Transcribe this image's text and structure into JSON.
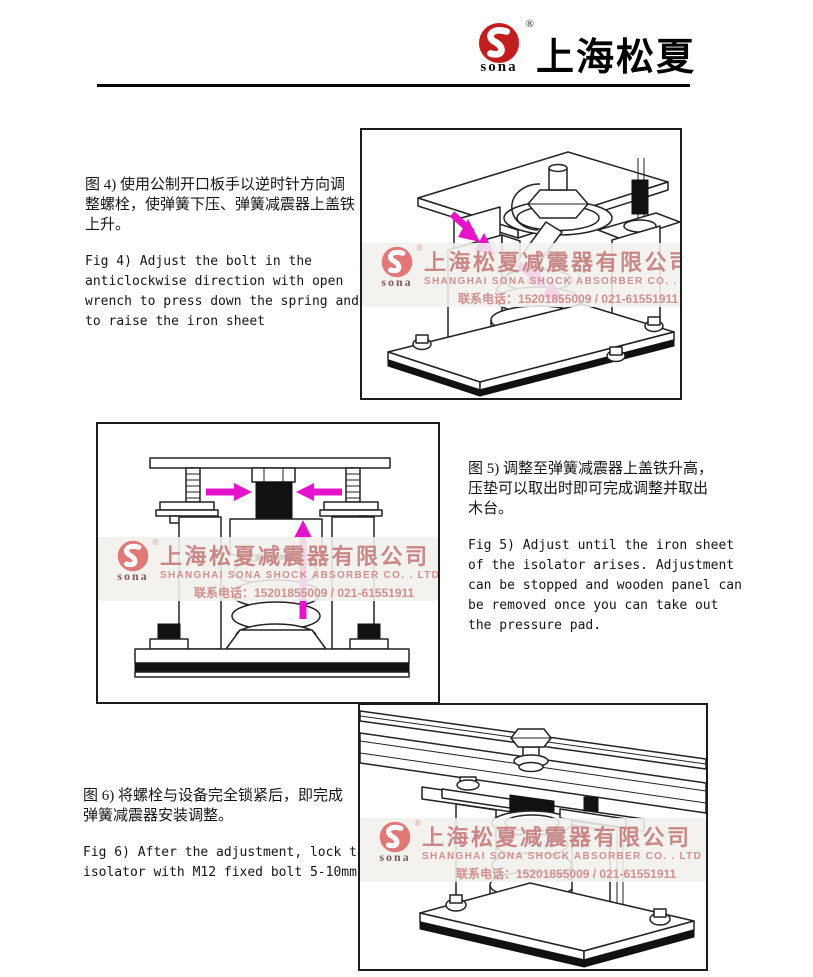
{
  "colors": {
    "accent": "#e513c9",
    "logo-red": "#c31e1e",
    "wm-pink": "#c98888",
    "wm-pink-light": "#d09090",
    "ink": "#1a1a1a"
  },
  "header": {
    "logo_text": "sona",
    "logo_reg": "®",
    "brand": "上海松夏"
  },
  "watermark": {
    "logo_text": "sona",
    "logo_reg": "®",
    "company_cn": "上海松夏减震器有限公司",
    "company_en": "SHANGHAI SONA SHOCK ABSORBER CO. . LTD",
    "phone_label": "联系电话：",
    "phone_numbers": "15201855009 / 021-61551911"
  },
  "sections": {
    "fig4": {
      "text_cn": "图 4) 使用公制开口板手以逆时针方向调\n整螺栓，使弹簧下压、弹簧减震器上盖铁\n上升。",
      "text_en": "Fig 4) Adjust the bolt in the\nanticlockwise  direction with open\nwrench to press  down the spring and\nto raise the iron sheet"
    },
    "fig5": {
      "text_cn": "图 5) 调整至弹簧减震器上盖铁升高，\n压垫可以取出时即可完成调整并取出\n木台。",
      "text_en": "Fig 5) Adjust until the iron sheet\nof the  isolator arises. Adjustment\ncan be stopped  and wooden panel can\nbe removed once  you can take out\nthe pressure pad."
    },
    "fig6": {
      "text_cn": "图 6) 将螺栓与设备完全锁紧后，即完成\n弹簧减震器安装调整。",
      "text_en": "Fig 6) After the adjustment, lock the\nisolator  with M12 fixed bolt 5-10mm"
    }
  }
}
